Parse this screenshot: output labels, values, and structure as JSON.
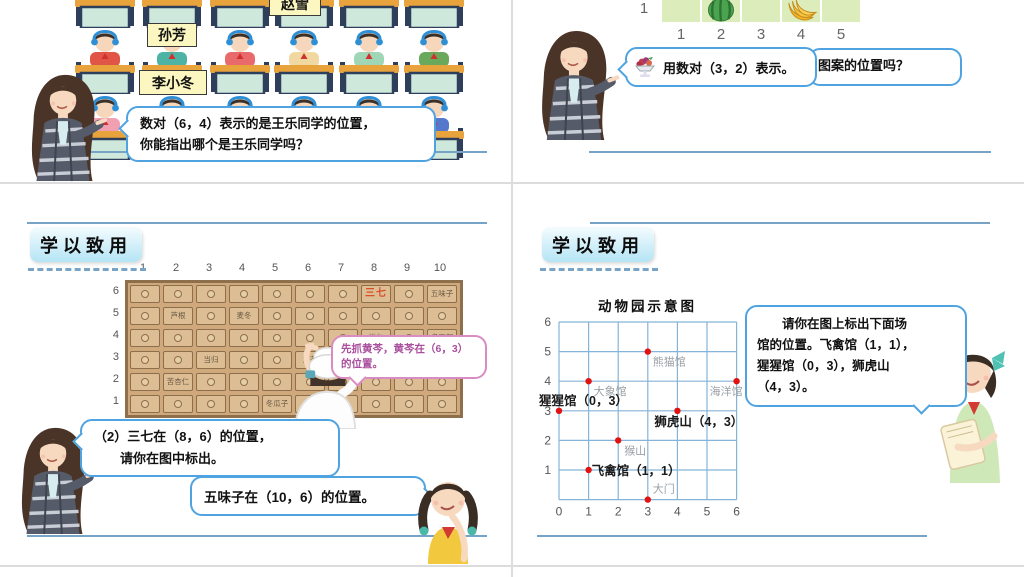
{
  "colors": {
    "slide_line": "#76a3c6",
    "bubble_border": "#4fa3e0",
    "purple_bubble": "#aa4f9e",
    "cabinet_bg": "#cfa87c",
    "drawer_red_label": "#d8502a",
    "zoo_grid_blue": "#85b4d8",
    "zoo_point_red": "#e11212",
    "zoo_gray_label": "#9aa0a6",
    "name_tag_bg": "#fcf7c0",
    "fruit_cell_bg": "#dcedbb"
  },
  "slide1": {
    "name_tag_top": "赵雪",
    "name_tag_mid": "孙芳",
    "name_tag_bottom": "李小冬",
    "bubble": {
      "line1": "数对（6，4）表示的是王乐同学的位置，",
      "line2": "你能指出哪个是王乐同学吗？"
    },
    "students": {
      "row1_shirts": [
        "#e05545",
        "#4db3a4",
        "#e86a6a",
        "#f0e6c8",
        "#9fd6b5",
        "#6aa85c"
      ],
      "row2_shirts": [
        "#e05545",
        "#4db3a4",
        "#e86a6a",
        "#f0d8a0",
        "#9fd6b5",
        "#6aa85c"
      ],
      "row3_shirts": [
        "#f0a0b0",
        "#4db3a4",
        "#c8e0a0",
        "#f0c840",
        "#f0b0c0",
        "#5577cc"
      ]
    }
  },
  "slide2": {
    "row_label": "1",
    "col_labels": [
      "1",
      "2",
      "3",
      "4",
      "5"
    ],
    "cells": [
      "",
      "watermelon",
      "",
      "banana",
      ""
    ],
    "bubble_back_text": "图案的位置吗？",
    "bubble_front_text": "用数对（3，2）表示。"
  },
  "slide3": {
    "header": "学以致用",
    "cabinet": {
      "col_labels": [
        "1",
        "2",
        "3",
        "4",
        "5",
        "6",
        "7",
        "8",
        "9",
        "10"
      ],
      "row_labels": [
        "6",
        "5",
        "4",
        "3",
        "2",
        "1"
      ],
      "labeled_drawers": [
        {
          "col": 8,
          "row": 6,
          "label": "三七",
          "highlight": true
        },
        {
          "col": 10,
          "row": 6,
          "label": "五味子"
        },
        {
          "col": 2,
          "row": 5,
          "label": "芦根"
        },
        {
          "col": 4,
          "row": 5,
          "label": "麦冬"
        },
        {
          "col": 8,
          "row": 4,
          "label": "桃仁"
        },
        {
          "col": 10,
          "row": 4,
          "label": "炙百部"
        },
        {
          "col": 3,
          "row": 3,
          "label": "当归"
        },
        {
          "col": 6,
          "row": 3,
          "label": "黄芩"
        },
        {
          "col": 2,
          "row": 2,
          "label": "苦杏仁"
        },
        {
          "col": 5,
          "row": 1,
          "label": "冬瓜子"
        }
      ]
    },
    "bubble_pharmacist": {
      "line1": "先抓黄芩，黄芩在（6，3）",
      "line2": "的位置。"
    },
    "bubble_teacher": {
      "line1": "（2）三七在（8，6）的位置，",
      "line2": "请你在图中标出。"
    },
    "bubble_girl": "五味子在（10，6）的位置。"
  },
  "slide4": {
    "header": "学以致用",
    "map_title": "动物园示意图",
    "x_labels": [
      "0",
      "1",
      "2",
      "3",
      "4",
      "5",
      "6"
    ],
    "y_labels": [
      "6",
      "5",
      "4",
      "3",
      "2",
      "1"
    ],
    "points": [
      {
        "x": 3,
        "y": 5,
        "label": "熊猫馆",
        "style": "gray",
        "dx": 5,
        "dy": 14,
        "anchor": "start"
      },
      {
        "x": 1,
        "y": 4,
        "label": "大象馆",
        "style": "gray",
        "dx": 5,
        "dy": 14,
        "anchor": "start"
      },
      {
        "x": 6,
        "y": 4,
        "label": "海洋馆",
        "style": "gray",
        "dx": 6,
        "dy": 14,
        "anchor": "end"
      },
      {
        "x": 0,
        "y": 3,
        "label": "猩猩馆（0，3）",
        "style": "black",
        "dx": -20,
        "dy": -6,
        "anchor": "start"
      },
      {
        "x": 4,
        "y": 3,
        "label": "狮虎山（4，3）",
        "style": "black",
        "dx": -23,
        "dy": 15,
        "anchor": "start"
      },
      {
        "x": 2,
        "y": 2,
        "label": "猴山",
        "style": "gray",
        "dx": 6,
        "dy": 14,
        "anchor": "start"
      },
      {
        "x": 1,
        "y": 1,
        "label": "飞禽馆（1，1）",
        "style": "black",
        "dx": 3,
        "dy": 5,
        "anchor": "start"
      },
      {
        "x": 3,
        "y": 0,
        "label": "大门",
        "style": "gray",
        "dx": 5,
        "dy": -7,
        "anchor": "start"
      }
    ],
    "bubble": {
      "line1": "请你在图上标出下面场",
      "line2": "馆的位置。飞禽馆（1，1），",
      "line3": "猩猩馆（0，3），狮虎山",
      "line4": "（4，3）。"
    }
  }
}
